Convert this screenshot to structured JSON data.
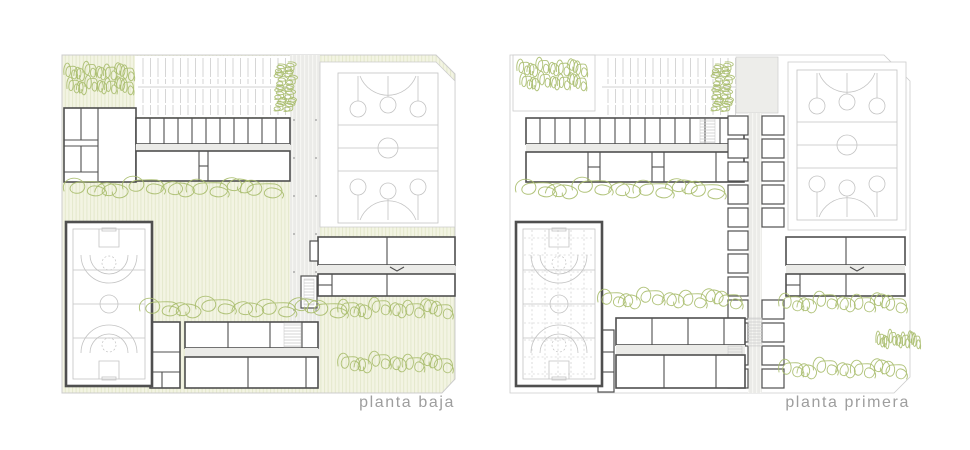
{
  "sheet": {
    "background": "#ffffff",
    "type": "architectural floor plan drawing, two plans side by side",
    "plans": [
      {
        "id": "planta-baja",
        "label": "planta baja"
      },
      {
        "id": "planta-primera",
        "label": "planta primera"
      }
    ]
  },
  "colors": {
    "background": "#ffffff",
    "ground_fill": "#f3f4e3",
    "ground_stripe": "#e4e8cc",
    "tree": "#a9bd6d",
    "wall": "#4f4f4f",
    "court": "#c3c3c3",
    "corridor": "#ebebe8",
    "corridor_stripe": "#f6f6f3",
    "parking": "#d2d2d2",
    "outline": "#cccccc",
    "label": "#9e9e9e"
  },
  "features": {
    "planta_baja": [
      "striped paved courtyard",
      "parking rows",
      "administration block",
      "north classroom wing",
      "central covered walkway",
      "outdoor double sports court",
      "east classroom wing",
      "south classroom wing",
      "gymnasium with sports court",
      "changing rooms",
      "tree rows"
    ],
    "planta_primera": [
      "north classroom wing",
      "parking rows at ground level",
      "outdoor double sports court at ground level",
      "central stacked-rooms wing with corridor",
      "east classroom wing",
      "south classroom wing",
      "gymnasium hall",
      "stair cores",
      "tree rows"
    ]
  }
}
